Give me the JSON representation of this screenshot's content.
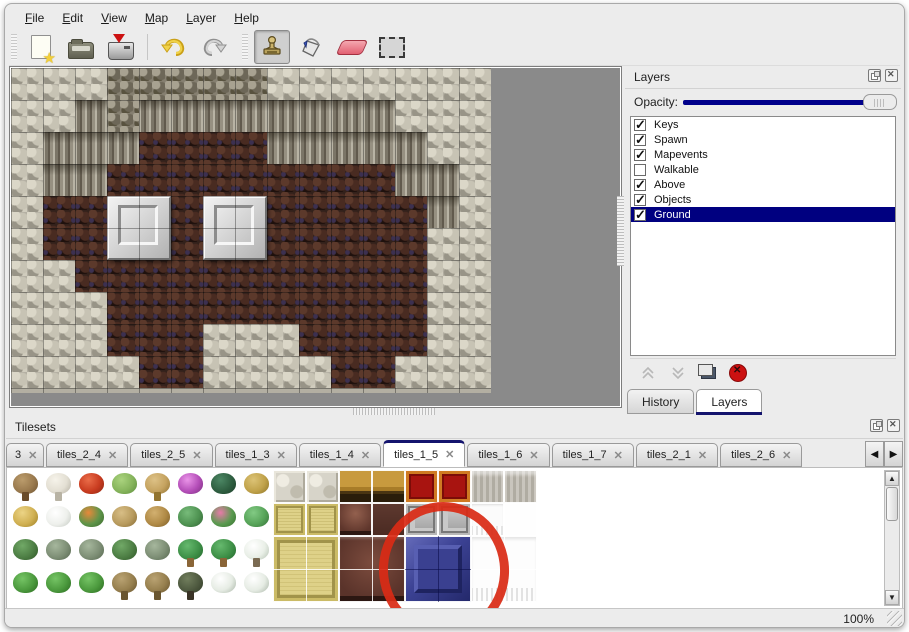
{
  "menu": {
    "items": [
      {
        "label": "File"
      },
      {
        "label": "Edit"
      },
      {
        "label": "View"
      },
      {
        "label": "Map"
      },
      {
        "label": "Layer"
      },
      {
        "label": "Help"
      }
    ]
  },
  "toolbar": {
    "buttons": [
      {
        "name": "new"
      },
      {
        "name": "open"
      },
      {
        "name": "save"
      },
      {
        "name": "undo"
      },
      {
        "name": "redo"
      },
      {
        "name": "stamp",
        "active": true
      },
      {
        "name": "fill"
      },
      {
        "name": "eraser"
      },
      {
        "name": "select"
      }
    ]
  },
  "map": {
    "tile_size": 32,
    "grid": [
      "PPPCCCCCPPPPPPP",
      "PPVCVVVVVVVVPPP",
      "PVVVFFFFVVVVVPP",
      "PVVFFFFFFFFFVVP",
      "PFFFFFFFFFFFFVP",
      "PFFFFFFFFFFFFPP",
      "PPFFFFFFFFFFFPP",
      "PPPFFFFFFFFFFPP",
      "PPPFFFPPPFFFFPP",
      "PPPPFFPPPPFFPPP"
    ],
    "platforms": [
      {
        "col": 3,
        "row": 4
      },
      {
        "col": 6,
        "row": 4
      }
    ]
  },
  "layers_panel": {
    "title": "Layers",
    "opacity_label": "Opacity:",
    "opacity_percent": 100,
    "layers": [
      {
        "name": "Keys",
        "checked": true,
        "selected": false
      },
      {
        "name": "Spawn",
        "checked": true,
        "selected": false
      },
      {
        "name": "Mapevents",
        "checked": true,
        "selected": false
      },
      {
        "name": "Walkable",
        "checked": false,
        "selected": false
      },
      {
        "name": "Above",
        "checked": true,
        "selected": false
      },
      {
        "name": "Objects",
        "checked": true,
        "selected": false
      },
      {
        "name": "Ground",
        "checked": true,
        "selected": true
      }
    ],
    "tabs": [
      {
        "label": "History",
        "active": false
      },
      {
        "label": "Layers",
        "active": true
      }
    ],
    "selection_color": "#000080",
    "slider_color": "#00008b"
  },
  "tilesets_panel": {
    "title": "Tilesets",
    "tabs": [
      {
        "label": "3",
        "partial": true,
        "active": false
      },
      {
        "label": "tiles_2_4",
        "active": false
      },
      {
        "label": "tiles_2_5",
        "active": false
      },
      {
        "label": "tiles_1_3",
        "active": false
      },
      {
        "label": "tiles_1_4",
        "active": false
      },
      {
        "label": "tiles_1_5",
        "active": true
      },
      {
        "label": "tiles_1_6",
        "active": false
      },
      {
        "label": "tiles_1_7",
        "active": false
      },
      {
        "label": "tiles_2_1",
        "active": false
      },
      {
        "label": "tiles_2_6",
        "active": false
      }
    ],
    "tile_size": 33,
    "tiles": [
      {
        "c": 0,
        "r": 0,
        "t": "tree-bare",
        "k": "n",
        "trunk": true
      },
      {
        "c": 1,
        "r": 0,
        "t": "tree-dead",
        "k": "n",
        "trunk": true
      },
      {
        "c": 2,
        "r": 0,
        "t": "flower-red",
        "k": "n"
      },
      {
        "c": 3,
        "r": 0,
        "t": "stump",
        "k": "n"
      },
      {
        "c": 4,
        "r": 0,
        "t": "trunk-tan",
        "k": "n",
        "trunk": true
      },
      {
        "c": 5,
        "r": 0,
        "t": "bush-pink",
        "k": "n"
      },
      {
        "c": 6,
        "r": 0,
        "t": "palm-dark",
        "k": "n"
      },
      {
        "c": 7,
        "r": 0,
        "t": "plant-yellow",
        "k": "n"
      },
      {
        "c": 0,
        "r": 1,
        "t": "hay",
        "k": "n"
      },
      {
        "c": 1,
        "r": 1,
        "t": "snow-pile",
        "k": "n"
      },
      {
        "c": 2,
        "r": 1,
        "t": "flowers-orange",
        "k": "n"
      },
      {
        "c": 3,
        "r": 1,
        "t": "dry-grass",
        "k": "n"
      },
      {
        "c": 4,
        "r": 1,
        "t": "leaves",
        "k": "n"
      },
      {
        "c": 5,
        "r": 1,
        "t": "lilypad",
        "k": "n"
      },
      {
        "c": 6,
        "r": 1,
        "t": "rose-bush",
        "k": "n"
      },
      {
        "c": 7,
        "r": 1,
        "t": "lilypad-big",
        "k": "n"
      },
      {
        "c": 0,
        "r": 2,
        "t": "sprouts",
        "k": "n"
      },
      {
        "c": 1,
        "r": 2,
        "t": "bush-gray",
        "k": "n"
      },
      {
        "c": 2,
        "r": 2,
        "t": "bush-gray",
        "k": "n"
      },
      {
        "c": 3,
        "r": 2,
        "t": "sprouts",
        "k": "n"
      },
      {
        "c": 4,
        "r": 2,
        "t": "bush-gray",
        "k": "n"
      },
      {
        "c": 5,
        "r": 2,
        "t": "palm",
        "k": "n",
        "trunk": true
      },
      {
        "c": 6,
        "r": 2,
        "t": "palm",
        "k": "n",
        "trunk": true
      },
      {
        "c": 7,
        "r": 2,
        "t": "snow-tree",
        "k": "n",
        "trunk": true
      },
      {
        "c": 0,
        "r": 3,
        "t": "conifer",
        "k": "n"
      },
      {
        "c": 1,
        "r": 3,
        "t": "conifer",
        "k": "n"
      },
      {
        "c": 2,
        "r": 3,
        "t": "conifer",
        "k": "n"
      },
      {
        "c": 3,
        "r": 3,
        "t": "dead-tree",
        "k": "n",
        "trunk": true
      },
      {
        "c": 4,
        "r": 3,
        "t": "dead-tree",
        "k": "n",
        "trunk": true
      },
      {
        "c": 5,
        "r": 3,
        "t": "dark-tree",
        "k": "n",
        "trunk": true
      },
      {
        "c": 6,
        "r": 3,
        "t": "snow-conifer",
        "k": "n"
      },
      {
        "c": 7,
        "r": 3,
        "t": "snow-conifer",
        "k": "n"
      },
      {
        "c": 8,
        "r": 0,
        "t": "stone",
        "k": "o"
      },
      {
        "c": 9,
        "r": 0,
        "t": "stone",
        "k": "o"
      },
      {
        "c": 10,
        "r": 0,
        "t": "wood",
        "k": "o"
      },
      {
        "c": 11,
        "r": 0,
        "t": "wood",
        "k": "o"
      },
      {
        "c": 12,
        "r": 0,
        "t": "carpet",
        "k": "o"
      },
      {
        "c": 13,
        "r": 0,
        "t": "carpet",
        "k": "o"
      },
      {
        "c": 14,
        "r": 0,
        "t": "grayfab",
        "k": "o"
      },
      {
        "c": 15,
        "r": 0,
        "t": "grayfab",
        "k": "o"
      },
      {
        "c": 8,
        "r": 1,
        "t": "tatami",
        "k": "o"
      },
      {
        "c": 9,
        "r": 1,
        "t": "tatami",
        "k": "o"
      },
      {
        "c": 10,
        "r": 1,
        "t": "seat",
        "k": "o"
      },
      {
        "c": 11,
        "r": 1,
        "t": "darkwood",
        "k": "o"
      },
      {
        "c": 12,
        "r": 1,
        "t": "metal",
        "k": "o"
      },
      {
        "c": 13,
        "r": 1,
        "t": "metal",
        "k": "o"
      },
      {
        "c": 14,
        "r": 1,
        "t": "curtain",
        "k": "o"
      },
      {
        "c": 15,
        "r": 1,
        "t": "white",
        "k": "o"
      },
      {
        "c": 8,
        "r": 2,
        "w": 2,
        "h": 2,
        "t": "tatami-big",
        "k": "o",
        "cross": true
      },
      {
        "c": 10,
        "r": 2,
        "w": 2,
        "h": 2,
        "t": "table-big",
        "k": "o",
        "cross": true
      },
      {
        "c": 12,
        "r": 2,
        "w": 2,
        "h": 2,
        "t": "blue-big",
        "k": "o",
        "cross": true,
        "bevel": true
      },
      {
        "c": 14,
        "r": 2,
        "w": 2,
        "h": 2,
        "t": "curtain-big",
        "k": "o",
        "cross": true
      }
    ],
    "annotation": {
      "shape": "ellipse",
      "color": "#d92b16",
      "circled_tile": "blue-big"
    }
  },
  "status_bar": {
    "zoom_level": "100%"
  }
}
